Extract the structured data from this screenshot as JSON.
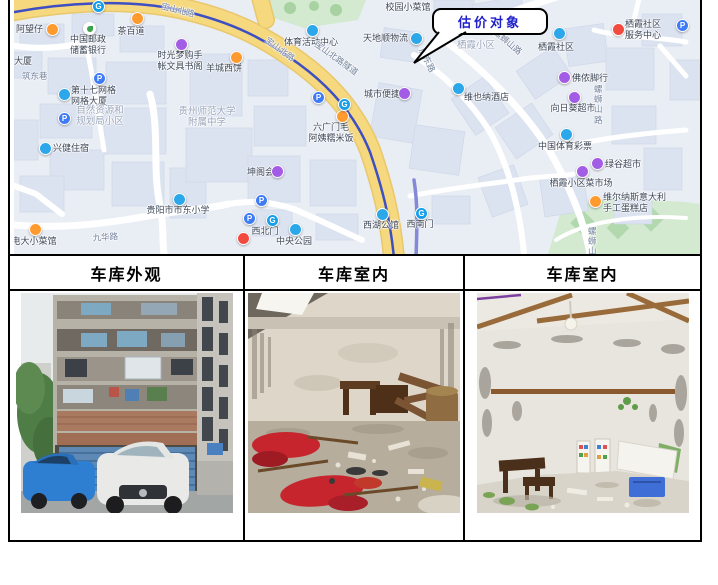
{
  "table": {
    "headers": [
      "车库外观",
      "车库室内",
      "车库室内"
    ]
  },
  "map": {
    "callout": {
      "label": "估价对象"
    },
    "colors": {
      "background": "#e9edf4",
      "main_road": "#f6d87e",
      "metro_line": "#3d4fc3",
      "secondary_line": "#8389d6",
      "green_area": "#d3e9d0",
      "building": "#dbe2f0",
      "callout_text": "#2121cc"
    },
    "markers": [
      {
        "icon": "metro",
        "ix": 78,
        "iy": 0
      },
      {
        "t": "宝山北路",
        "lx": 148,
        "ly": 5,
        "cls": "road",
        "rot": 14
      },
      {
        "t": "阿望仔",
        "lx": 2,
        "ly": 24,
        "cls": "poi",
        "align": "l",
        "icon": "orange",
        "ix": 32,
        "iy": 23
      },
      {
        "t": "茶百道",
        "lx": 117,
        "ly": 26,
        "cls": "poi",
        "align": "c",
        "icon": "orange",
        "ix": 117,
        "iy": 12
      },
      {
        "t": "中国邮政\n储蓄银行",
        "lx": 74,
        "ly": 34,
        "cls": "poi",
        "align": "c",
        "icon": "leaf",
        "ix": 69,
        "iy": 22
      },
      {
        "t": "时光梦购手\n帐文具书阁",
        "lx": 166,
        "ly": 50,
        "cls": "poi",
        "align": "c",
        "icon": "purple",
        "ix": 161,
        "iy": 38
      },
      {
        "t": "羊城西饼",
        "lx": 210,
        "ly": 63,
        "cls": "poi",
        "align": "c",
        "icon": "orange",
        "ix": 216,
        "iy": 51
      },
      {
        "t": "大厦",
        "lx": 0,
        "ly": 56,
        "cls": "poi",
        "align": "l"
      },
      {
        "t": "筑东巷",
        "lx": 8,
        "ly": 71,
        "cls": "road",
        "align": "l"
      },
      {
        "icon": "parking",
        "ix": 79,
        "iy": 72
      },
      {
        "t": "第十七网格\n网格大厦",
        "lx": 57,
        "ly": 85,
        "cls": "poi",
        "align": "l",
        "icon": "blue",
        "ix": 44,
        "iy": 88
      },
      {
        "icon": "parking",
        "ix": 44,
        "iy": 112
      },
      {
        "t": "自然资源和\n规划局小区",
        "lx": 86,
        "ly": 105,
        "cls": "area",
        "align": "c"
      },
      {
        "t": "贵州师范大学\n附属中学",
        "lx": 193,
        "ly": 106,
        "cls": "area",
        "align": "c"
      },
      {
        "t": "兴健住宿",
        "lx": 39,
        "ly": 143,
        "cls": "poi",
        "align": "l",
        "icon": "blue",
        "ix": 25,
        "iy": 142
      },
      {
        "t": "坤阁会",
        "lx": 233,
        "ly": 167,
        "cls": "poi",
        "align": "l",
        "icon": "purple",
        "ix": 257,
        "iy": 165
      },
      {
        "icon": "parking",
        "ix": 241,
        "iy": 194
      },
      {
        "t": "电大小菜馆",
        "lx": 20,
        "ly": 236,
        "cls": "poi",
        "align": "c",
        "icon": "orange",
        "ix": 15,
        "iy": 223
      },
      {
        "t": "九华路",
        "lx": 91,
        "ly": 232,
        "cls": "road",
        "align": "c",
        "rot": -4
      },
      {
        "t": "贵阳市市东小学",
        "lx": 164,
        "ly": 205,
        "cls": "poi",
        "align": "c",
        "icon": "blue",
        "ix": 159,
        "iy": 193
      },
      {
        "icon": "parking",
        "ix": 229,
        "iy": 212
      },
      {
        "icon": "metro",
        "ix": 252,
        "iy": 214
      },
      {
        "t": "西北门",
        "lx": 251,
        "ly": 226,
        "cls": "poi",
        "align": "c"
      },
      {
        "icon": "red",
        "ix": 223,
        "iy": 232
      },
      {
        "t": "六广门毛\n阿姨糯米饭",
        "lx": 317,
        "ly": 122,
        "cls": "poi",
        "align": "c",
        "icon": "orange",
        "ix": 322,
        "iy": 110
      },
      {
        "icon": "parking",
        "ix": 298,
        "iy": 91
      },
      {
        "icon": "metro",
        "ix": 324,
        "iy": 98
      },
      {
        "t": "中央公园",
        "lx": 280,
        "ly": 236,
        "cls": "poi",
        "align": "c",
        "icon": "blue",
        "ix": 275,
        "iy": 223
      },
      {
        "t": "西湖公馆",
        "lx": 367,
        "ly": 220,
        "cls": "poi",
        "align": "c",
        "icon": "blue",
        "ix": 362,
        "iy": 208
      },
      {
        "t": "西南门",
        "lx": 406,
        "ly": 219,
        "cls": "poi",
        "align": "c",
        "icon": "metro",
        "ix": 401,
        "iy": 207
      },
      {
        "t": "体育活动中心",
        "lx": 297,
        "ly": 37,
        "cls": "poi",
        "align": "c",
        "icon": "blue",
        "ix": 292,
        "iy": 24
      },
      {
        "t": "校园小菜馆",
        "lx": 394,
        "ly": 2,
        "cls": "poi",
        "align": "c"
      },
      {
        "t": "天地顺物流",
        "lx": 349,
        "ly": 33,
        "cls": "poi",
        "align": "l",
        "icon": "blue",
        "ix": 396,
        "iy": 32
      },
      {
        "t": "宝山北路",
        "lx": 252,
        "ly": 45,
        "cls": "road",
        "rot": 36
      },
      {
        "t": "宝山北路隧道",
        "lx": 300,
        "ly": 54,
        "cls": "road",
        "rot": 36
      },
      {
        "t": "服东路",
        "lx": 405,
        "ly": 58,
        "cls": "road",
        "rot": 64
      },
      {
        "t": "城市便捷",
        "lx": 350,
        "ly": 89,
        "cls": "poi",
        "align": "l",
        "icon": "purple",
        "ix": 384,
        "iy": 87
      },
      {
        "t": "维也纳酒店",
        "lx": 450,
        "ly": 92,
        "cls": "poi",
        "align": "l",
        "icon": "blue",
        "ix": 438,
        "iy": 82
      },
      {
        "t": "栖霞小区",
        "lx": 443,
        "ly": 40,
        "cls": "area",
        "align": "l"
      },
      {
        "t": "螺蛳山路",
        "lx": 480,
        "ly": 38,
        "cls": "road",
        "rot": 40
      },
      {
        "t": "栖霞社区",
        "lx": 542,
        "ly": 42,
        "cls": "poi",
        "align": "c",
        "icon": "blue",
        "ix": 539,
        "iy": 27
      },
      {
        "t": "栖霞社区\n服务中心",
        "lx": 611,
        "ly": 19,
        "cls": "poi",
        "align": "l",
        "icon": "red",
        "ix": 598,
        "iy": 23
      },
      {
        "icon": "parking",
        "ix": 662,
        "iy": 19
      },
      {
        "t": "佛侬脚行",
        "lx": 558,
        "ly": 73,
        "cls": "poi",
        "align": "l",
        "icon": "purple",
        "ix": 544,
        "iy": 71
      },
      {
        "t": "向日葵超市",
        "lx": 559,
        "ly": 103,
        "cls": "poi",
        "align": "c",
        "icon": "purple",
        "ix": 554,
        "iy": 91
      },
      {
        "t": "螺\n蛳\n山\n路",
        "lx": 580,
        "ly": 84,
        "cls": "road",
        "align": "l"
      },
      {
        "t": "中国体育彩票",
        "lx": 551,
        "ly": 141,
        "cls": "poi",
        "align": "c",
        "icon": "blue",
        "ix": 546,
        "iy": 128
      },
      {
        "t": "绿谷超市",
        "lx": 591,
        "ly": 159,
        "cls": "poi",
        "align": "l",
        "icon": "purple",
        "ix": 577,
        "iy": 157
      },
      {
        "t": "栖霞小区菜市场",
        "lx": 567,
        "ly": 178,
        "cls": "poi",
        "align": "c",
        "icon": "purple",
        "ix": 562,
        "iy": 165
      },
      {
        "t": "维尔纳斯意大利\n手工蛋糕店",
        "lx": 589,
        "ly": 192,
        "cls": "poi",
        "align": "l",
        "icon": "orange",
        "ix": 575,
        "iy": 195
      },
      {
        "t": "螺\n蛳\n山",
        "lx": 574,
        "ly": 226,
        "cls": "road",
        "align": "l"
      }
    ]
  },
  "photos": [
    {
      "caption": "车库外观",
      "alt": "multi-storey residential building with blue garage roller shutters, blue car and white car parked in front"
    },
    {
      "caption": "车库室内",
      "alt": "cluttered garage interior with stained walls, wooden furniture, barrel and red cloth debris on floor"
    },
    {
      "caption": "车库室内",
      "alt": "garage interior with stained white walls, wooden ceiling beams, hanging bulb, stools and blue crate"
    }
  ]
}
